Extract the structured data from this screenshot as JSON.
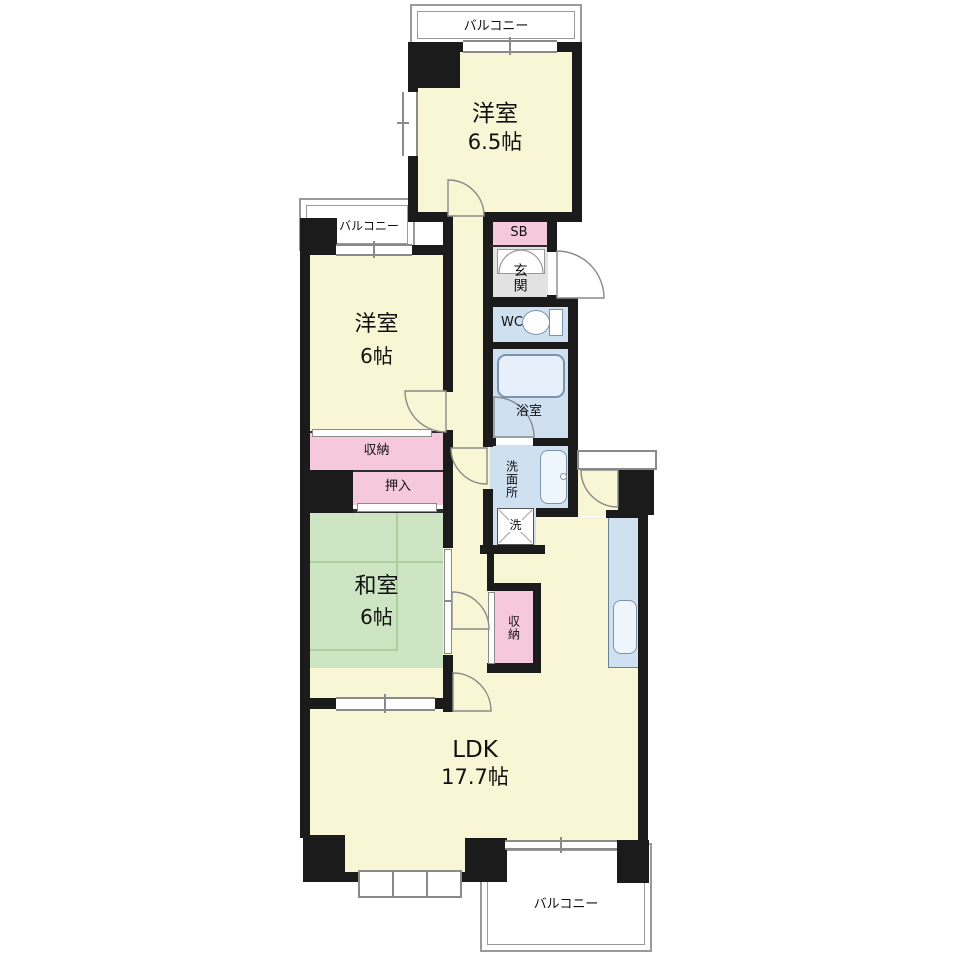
{
  "plan": {
    "balconies": {
      "top": "バルコニー",
      "left": "バルコニー",
      "bottom": "バルコニー"
    },
    "rooms": {
      "western1": {
        "name": "洋室",
        "size": "6.5帖"
      },
      "western2": {
        "name": "洋室",
        "size": "6帖"
      },
      "japanese": {
        "name": "和室",
        "size": "6帖"
      },
      "ldk": {
        "name": "LDK",
        "size": "17.7帖"
      }
    },
    "labels": {
      "shoe_box": "SB",
      "entrance": "玄関",
      "toilet": "WC",
      "bathroom": "浴室",
      "washroom": "洗面所",
      "laundry": "洗",
      "storage_hall": "収納",
      "closet": "押入",
      "storage_ldk": "収納"
    },
    "colors": {
      "room_yellow": "#f8f6d4",
      "tatami_green": "#cde5c2",
      "storage_pink": "#f6c8dc",
      "wet_area_blue": "#cfe1f1",
      "entrance_gray": "#e2e2e2",
      "wall_black": "#1b1b1b"
    }
  }
}
